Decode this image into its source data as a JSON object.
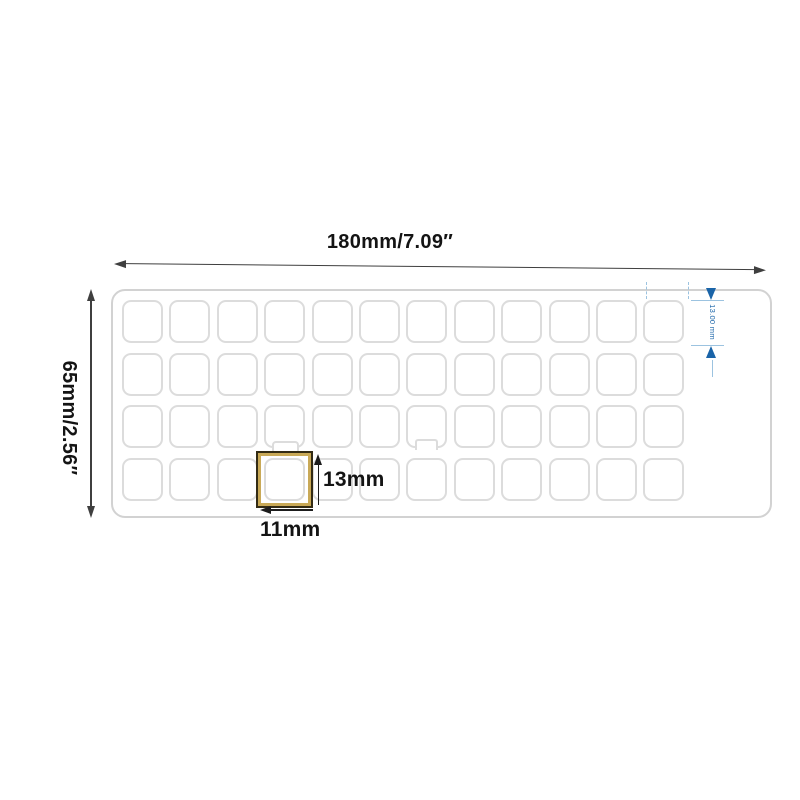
{
  "labels": {
    "sheet_width": "180mm/7.09″",
    "sheet_height": "65mm/2.56″",
    "sticker_height": "13mm",
    "sticker_width": "11mm",
    "row_height_blue": "13.00 mm"
  },
  "grid": {
    "rows": 4,
    "columns": 12
  },
  "colors": {
    "dimension_line": "#3f3f3f",
    "text": "#141414",
    "sheet_border": "#d2d2d2",
    "sticker_border": "#dcdcdc",
    "highlight_outer": "#332b14",
    "highlight_gold": "#c9a957",
    "blue_accent": "#1a64a8",
    "blue_light": "#9cc3e0"
  }
}
